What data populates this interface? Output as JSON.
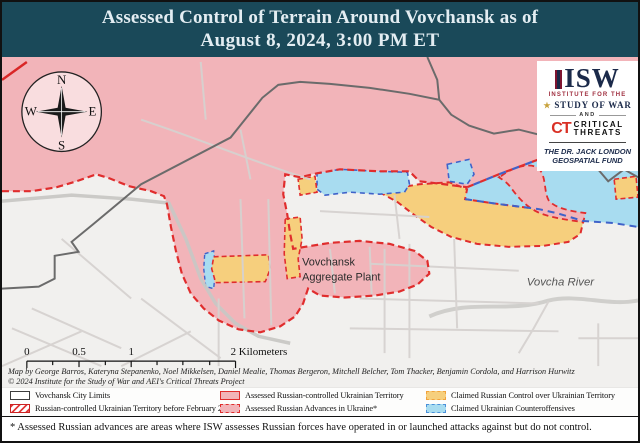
{
  "title": {
    "line1": "Assessed Control of Terrain Around Vovchansk as of",
    "line2": "August 8, 2024, 3:00 PM ET"
  },
  "logo": {
    "isw": "ISW",
    "institute_small": "INSTITUTE FOR THE",
    "study_of_war": "STUDY OF WAR",
    "star": "★",
    "and": "AND",
    "ct": "CT",
    "critical": "CRITICAL",
    "threats": "THREATS",
    "fund_line1": "THE DR. JACK LONDON",
    "fund_line2": "GEOSPATIAL FUND"
  },
  "compass": {
    "n": "N",
    "e": "E",
    "s": "S",
    "w": "W"
  },
  "map_labels": {
    "plant_line1": "Vovchansk",
    "plant_line2": "Aggregate Plant",
    "river": "Vovcha River"
  },
  "scale_bar": {
    "tick0": "0",
    "tick05": "0.5",
    "tick1": "1",
    "tick2": "2 Kilometers"
  },
  "attribution": {
    "line1": "Map by George Barros, Kateryna Stepanenko, Noel Mikkelsen, Daniel Mealie, Thomas Bergeron, Mitchell Belcher, Tom Thacker, Benjamin Cordola, and Harrison Hurwitz",
    "line2": "© 2024 Institute for the Study of War and AEI's Critical Threats Project"
  },
  "legend": {
    "items": [
      {
        "label": "Vovchansk City Limits",
        "swatch": "white-outline"
      },
      {
        "label": "Russian-controlled Ukrainian Territory before February 24",
        "swatch": "red-hatched"
      },
      {
        "label": "Assessed Russian-controlled Ukrainian Territory",
        "swatch": "pink-solid-red-border"
      },
      {
        "label": "Assessed Russian Advances in Ukraine*",
        "swatch": "pink-dashed-red-border"
      },
      {
        "label": "Claimed Russian Control over Ukrainian Territory",
        "swatch": "yellow-dashed-orange-border"
      },
      {
        "label": "Claimed Ukrainian Counteroffensives",
        "swatch": "blue-dashed-blue-border"
      }
    ]
  },
  "footnote": "* Assessed Russian advances are areas where ISW assesses Russian forces have operated in or launched attacks against but do not control.",
  "colors": {
    "title_bg": "#1a4959",
    "russian_controlled_pink": "#f2b4b9",
    "claimed_russian_yellow": "#f6cf7d",
    "counteroffensive_blue": "#a8dcf0",
    "red_border": "#e02d2d",
    "blue_border": "#3f62c9",
    "orange_border": "#f2a33c",
    "map_background": "#f1f0ee",
    "isw_navy": "#1b2a4a",
    "ct_red": "#d93025"
  }
}
